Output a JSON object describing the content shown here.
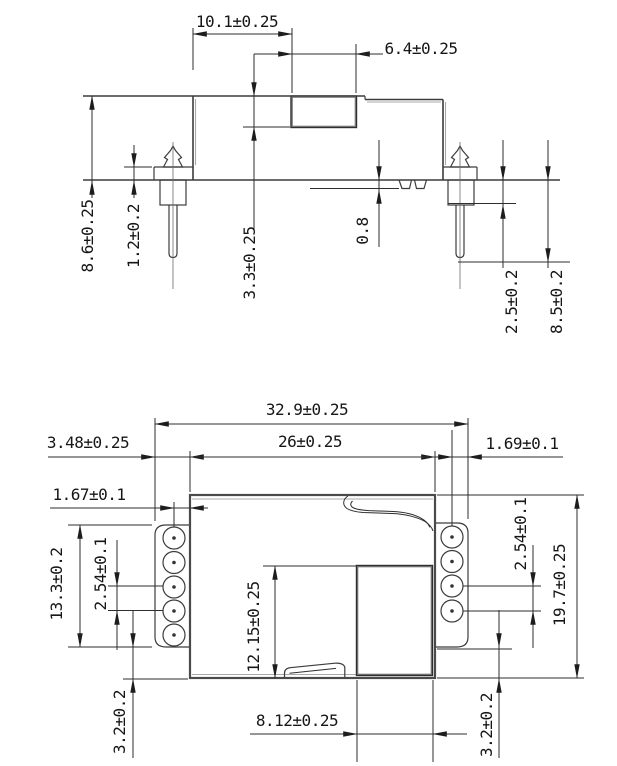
{
  "drawing": {
    "colors": {
      "line": "#3c3c3c",
      "dimension_line": "#2e2e2e",
      "text": "#161616",
      "background": "#ffffff"
    },
    "side_view": {
      "dim_top_width": "10.1±0.25",
      "dim_block_width": "6.4±0.25",
      "dim_overall_height": "8.6±0.25",
      "dim_flange_height": "1.2±0.2",
      "dim_recess_depth": "3.3±0.25",
      "dim_boss_height": "0.8",
      "dim_shoulder_length": "2.5±0.2",
      "dim_pin_length": "8.5±0.2"
    },
    "bottom_view": {
      "dim_overall_width": "32.9±0.25",
      "dim_tab_left_offset": "3.48±0.25",
      "dim_body_width": "26±0.25",
      "dim_hole_to_edge_right": "1.69±0.1",
      "dim_hole_to_edge_left": "1.67±0.1",
      "dim_tab_span": "13.3±0.2",
      "dim_pin_pitch_left": "2.54±0.1",
      "dim_pin_pitch_right": "2.54±0.1",
      "dim_body_depth": "19.7±0.25",
      "dim_chamber_depth": "12.15±0.25",
      "dim_chamber_width": "8.12±0.25",
      "dim_bottom_clearance_left": "3.2±0.2",
      "dim_bottom_clearance_right": "3.2±0.2"
    }
  }
}
